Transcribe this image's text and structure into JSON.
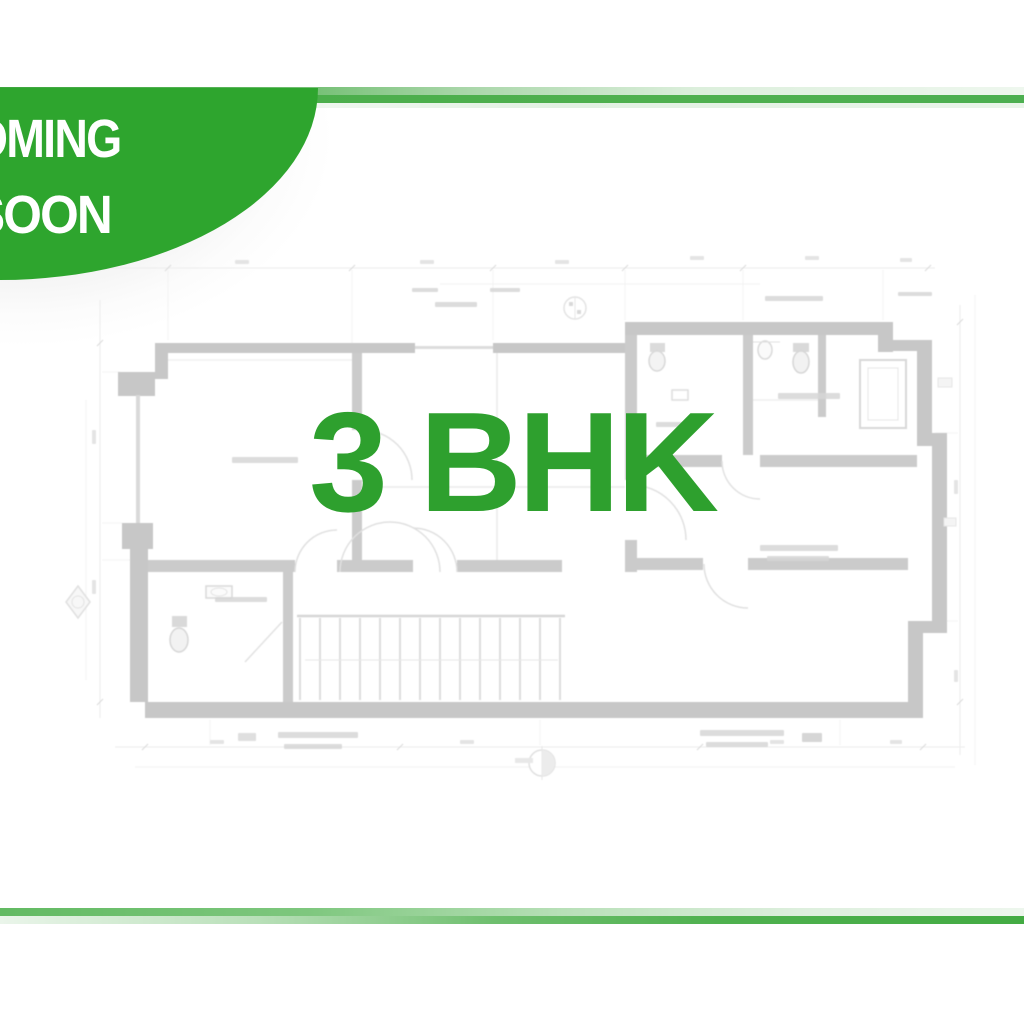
{
  "badge": {
    "line1": "COMING",
    "line2": "SOON",
    "background_color": "#2ea52e",
    "text_color": "#ffffff"
  },
  "headline": {
    "text": "3 BHK",
    "color": "#2ea02e"
  },
  "accent_bars": {
    "green_dark": "#43ab43",
    "green_mid": "#62ba62",
    "green_light": "#dcefdc"
  },
  "floor_plan": {
    "wall_color": "#c7c7c7",
    "detail_line_color": "#dedede",
    "dimension_line_color": "#ededed"
  }
}
